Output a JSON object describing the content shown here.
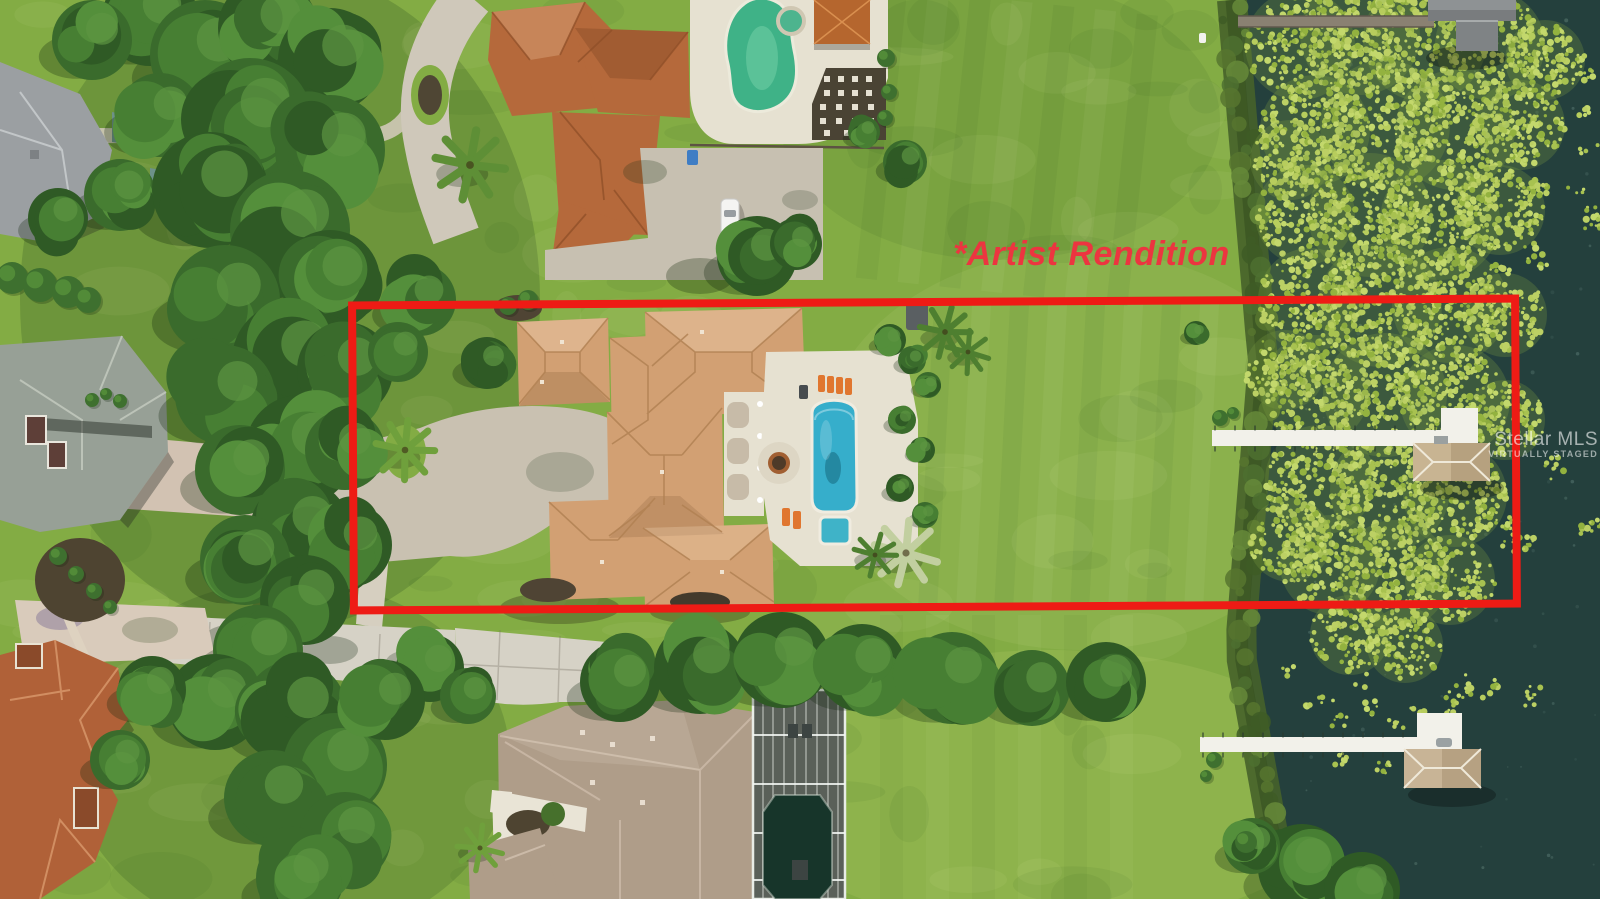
{
  "annotation": {
    "artist_rendition": "*Artist Rendition"
  },
  "watermark": {
    "brand": "Stellar MLS",
    "tagline": "VIRTUALLY STAGED"
  },
  "palette": {
    "boundary_red": "#EE1B15",
    "annotation_red": "#EC3540",
    "lawn_green": "#83AC44",
    "lawn_shade": "#6E9A3A",
    "water_teal": "#24403D",
    "lily_pad_green": "#B6CC5B",
    "shore_olive": "#4C682C",
    "tree_green": "#3A6B2C",
    "main_roof_tan": "#D2A073",
    "neighbor_roof_orange": "#B5693B",
    "neighbor_roof_gray": "#9BA09E",
    "neighbor_roof_brown": "#AF9D89",
    "pool_blue": "#36AECB",
    "neighbor_pool_green": "#3FB287",
    "paver_gray": "#C9C1B1",
    "deck_cream": "#E6E1D1",
    "dock_white": "#F2F1EA",
    "concrete": "#D6D2C6"
  }
}
